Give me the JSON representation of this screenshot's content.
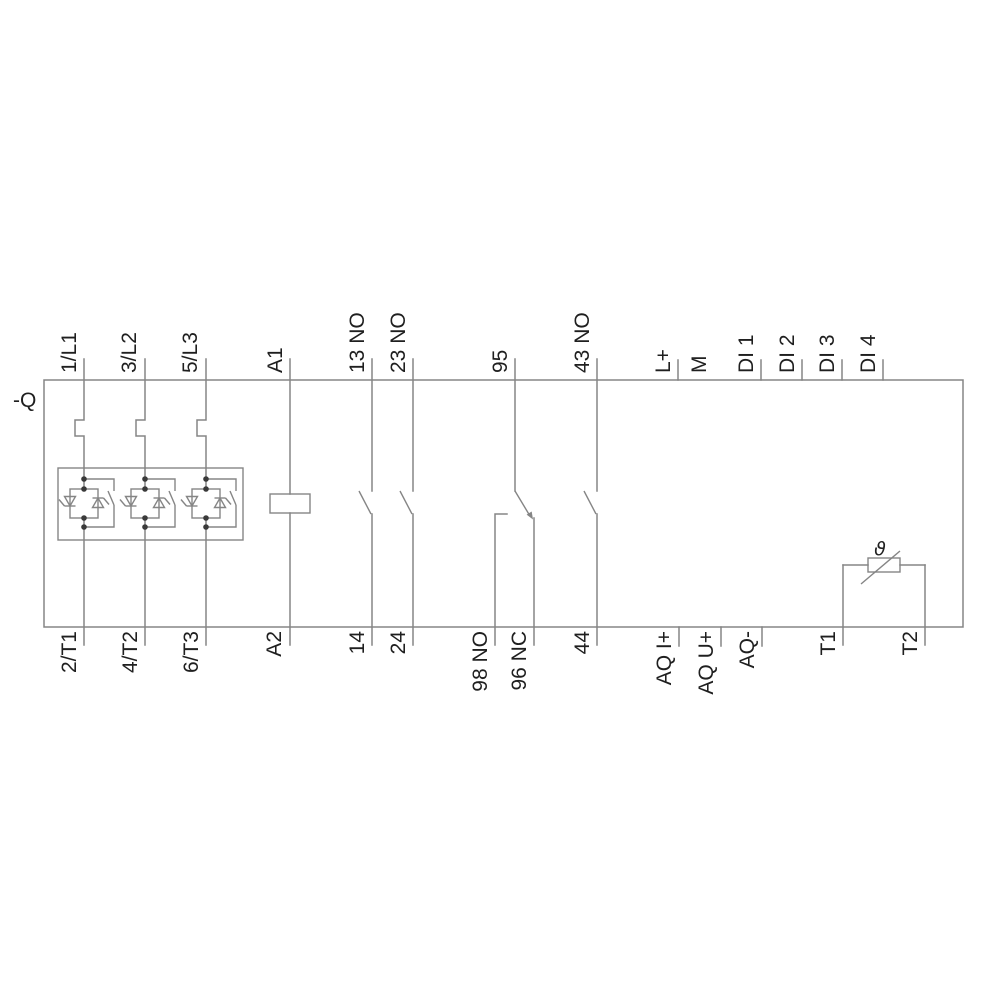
{
  "device": {
    "designation": "-Q",
    "thermistor_symbol": "ϑ"
  },
  "terminals": {
    "top": [
      {
        "label": "1/L1"
      },
      {
        "label": "3/L2"
      },
      {
        "label": "5/L3"
      },
      {
        "label": "A1"
      },
      {
        "label": "13 NO"
      },
      {
        "label": "23 NO"
      },
      {
        "label": "95"
      },
      {
        "label": "43 NO"
      },
      {
        "label": "L+"
      },
      {
        "label": "M"
      },
      {
        "label": "DI 1"
      },
      {
        "label": "DI 2"
      },
      {
        "label": "DI 3"
      },
      {
        "label": "DI 4"
      }
    ],
    "bottom": [
      {
        "label": "2/T1"
      },
      {
        "label": "4/T2"
      },
      {
        "label": "6/T3"
      },
      {
        "label": "A2"
      },
      {
        "label": "14"
      },
      {
        "label": "24"
      },
      {
        "label": "98 NO"
      },
      {
        "label": "96 NC"
      },
      {
        "label": "44"
      },
      {
        "label": "AQ I+"
      },
      {
        "label": "AQ U+"
      },
      {
        "label": "AQ-"
      },
      {
        "label": "T1"
      },
      {
        "label": "T2"
      }
    ]
  },
  "colors": {
    "background": "#ffffff",
    "line": "#858585",
    "text": "#1f1f1f",
    "junction_dot": "#3a3a3a"
  }
}
